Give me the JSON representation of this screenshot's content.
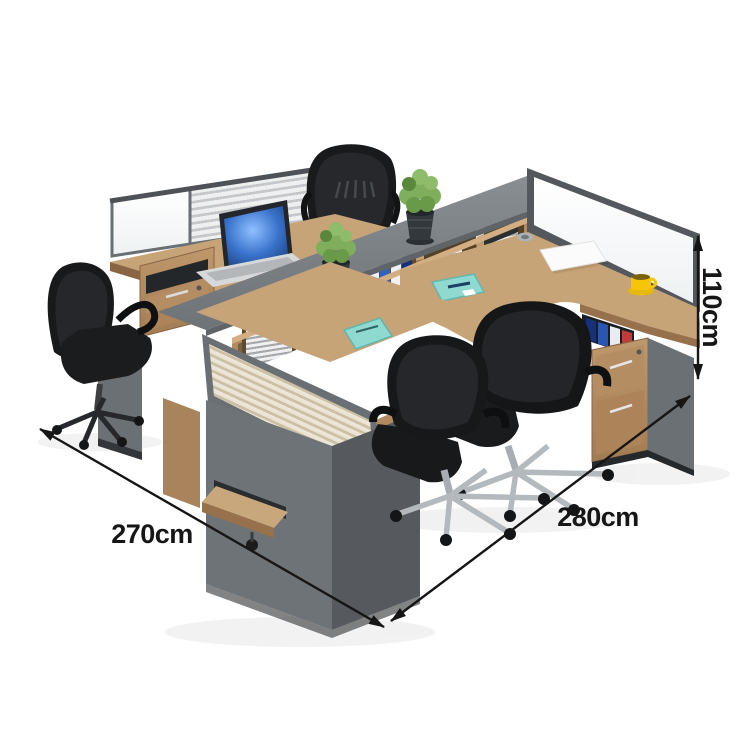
{
  "image": {
    "kind": "product-photo",
    "description": "Four-person L-shaped office staff workstation cluster in walnut wood and grey panels, with central storage hutch riser, slatted and frosted glass privacy partitions, pedestal drawer cabinets, laptop, plants, mugs and four black mesh swivel chairs on a white background",
    "background": "#ffffff"
  },
  "annotations": {
    "width_label": "270cm",
    "depth_label": "280cm",
    "height_label": "110cm"
  },
  "palette": {
    "wood_top": "#c7a378",
    "wood_front": "#b08a60",
    "wood_shadow": "#96714b",
    "grey_top_band": "#7c8184",
    "grey_panel": "#6b7074",
    "grey_dark_frame": "#54585c",
    "chair_black": "#17181a",
    "chrome": "#b4b9be",
    "plant_green": "#7fae5c",
    "pot_dark": "#33383c",
    "notebook_teal": "#8fd9d0",
    "cup_yellow": "#f6c50a",
    "binder_blue": "#2f63c0",
    "screen_blue": "#3a73cc",
    "dimension_ink": "#161616"
  },
  "objects": [
    "storage-hutch",
    "glass-partition",
    "slat-partition",
    "laptop",
    "potted-plant",
    "office-chair",
    "pedestal-cabinet",
    "keyboard-tray",
    "document-pad",
    "coffee-cup",
    "notebook",
    "binders",
    "document-tray-stack",
    "cable-grommet"
  ]
}
